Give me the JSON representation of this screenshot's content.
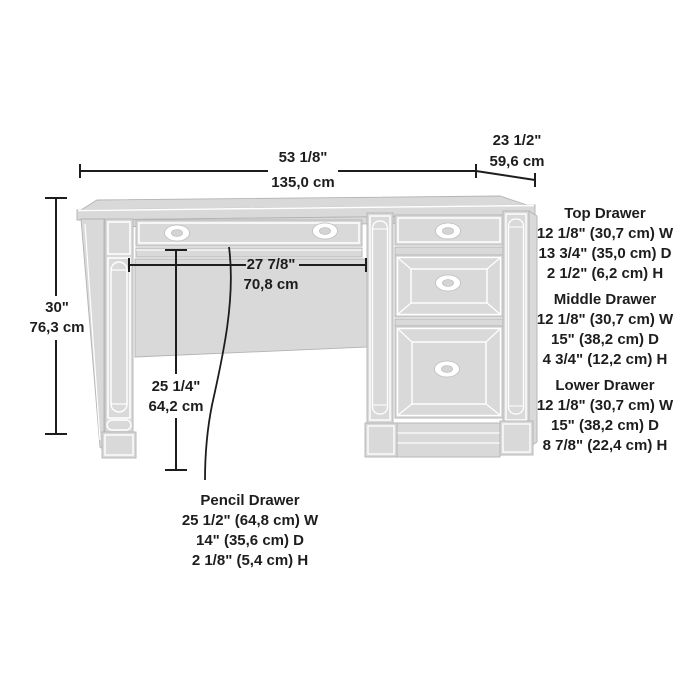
{
  "overall_dimensions": {
    "width": {
      "inches": "53 1/8\"",
      "metric": "135,0 cm"
    },
    "depth": {
      "inches": "23 1/2\"",
      "metric": "59,6 cm"
    },
    "height": {
      "inches": "30\"",
      "metric": "76,3 cm"
    },
    "opening_width": {
      "inches": "27 7/8\"",
      "metric": "70,8 cm"
    },
    "opening_height": {
      "inches": "25 1/4\"",
      "metric": "64,2 cm"
    }
  },
  "drawer_specs": [
    {
      "title": "Top Drawer",
      "lines": [
        "12 1/8\" (30,7 cm) W",
        "13 3/4\" (35,0 cm) D",
        "2 1/2\" (6,2 cm) H"
      ]
    },
    {
      "title": "Middle Drawer",
      "lines": [
        "12 1/8\" (30,7 cm) W",
        "15\" (38,2 cm) D",
        "4 3/4\" (12,2 cm) H"
      ]
    },
    {
      "title": "Lower Drawer",
      "lines": [
        "12 1/8\" (30,7 cm) W",
        "15\" (38,2 cm) D",
        "8 7/8\" (22,4 cm) H"
      ]
    },
    {
      "title": "Pencil Drawer",
      "lines": [
        "25 1/2\" (64,8 cm) W",
        "14\" (35,6 cm) D",
        "2 1/8\" (5,4 cm) H"
      ]
    }
  ],
  "colors": {
    "background": "#ffffff",
    "furniture_fill": "#d9d9d9",
    "furniture_outline": "#b3b3b3",
    "furniture_detail_line": "#ffffff",
    "dimension_line": "#1d1d1d",
    "text": "#1d1d1d"
  }
}
